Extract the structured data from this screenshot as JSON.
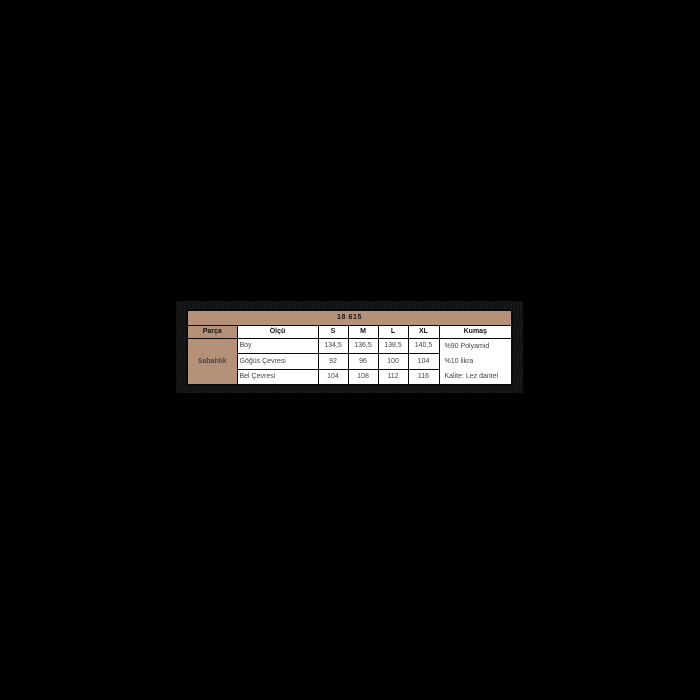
{
  "canvas": {
    "background_color": "#000000"
  },
  "size_table": {
    "title": "18 615",
    "columns": [
      "Parça",
      "Ölçü",
      "S",
      "M",
      "L",
      "XL",
      "Kumaş"
    ],
    "group_label": "Sabahlık",
    "rows": [
      {
        "label": "Boy",
        "values": [
          "134,5",
          "136,5",
          "138,5",
          "140,5"
        ]
      },
      {
        "label": "Göğüs Çevresi",
        "values": [
          "92",
          "96",
          "100",
          "104"
        ]
      },
      {
        "label": "Bel Çevresi",
        "values": [
          "104",
          "108",
          "112",
          "116"
        ]
      }
    ],
    "fabric_lines": [
      "%90 Polyamid",
      "%10 likra",
      "Kalite: Lez dantel"
    ],
    "colors": {
      "accent_tan": "#b6917a",
      "cell_white": "#ffffff",
      "border_black": "#0a0a0a",
      "data_text": "#474747",
      "header_text": "#141414"
    }
  }
}
